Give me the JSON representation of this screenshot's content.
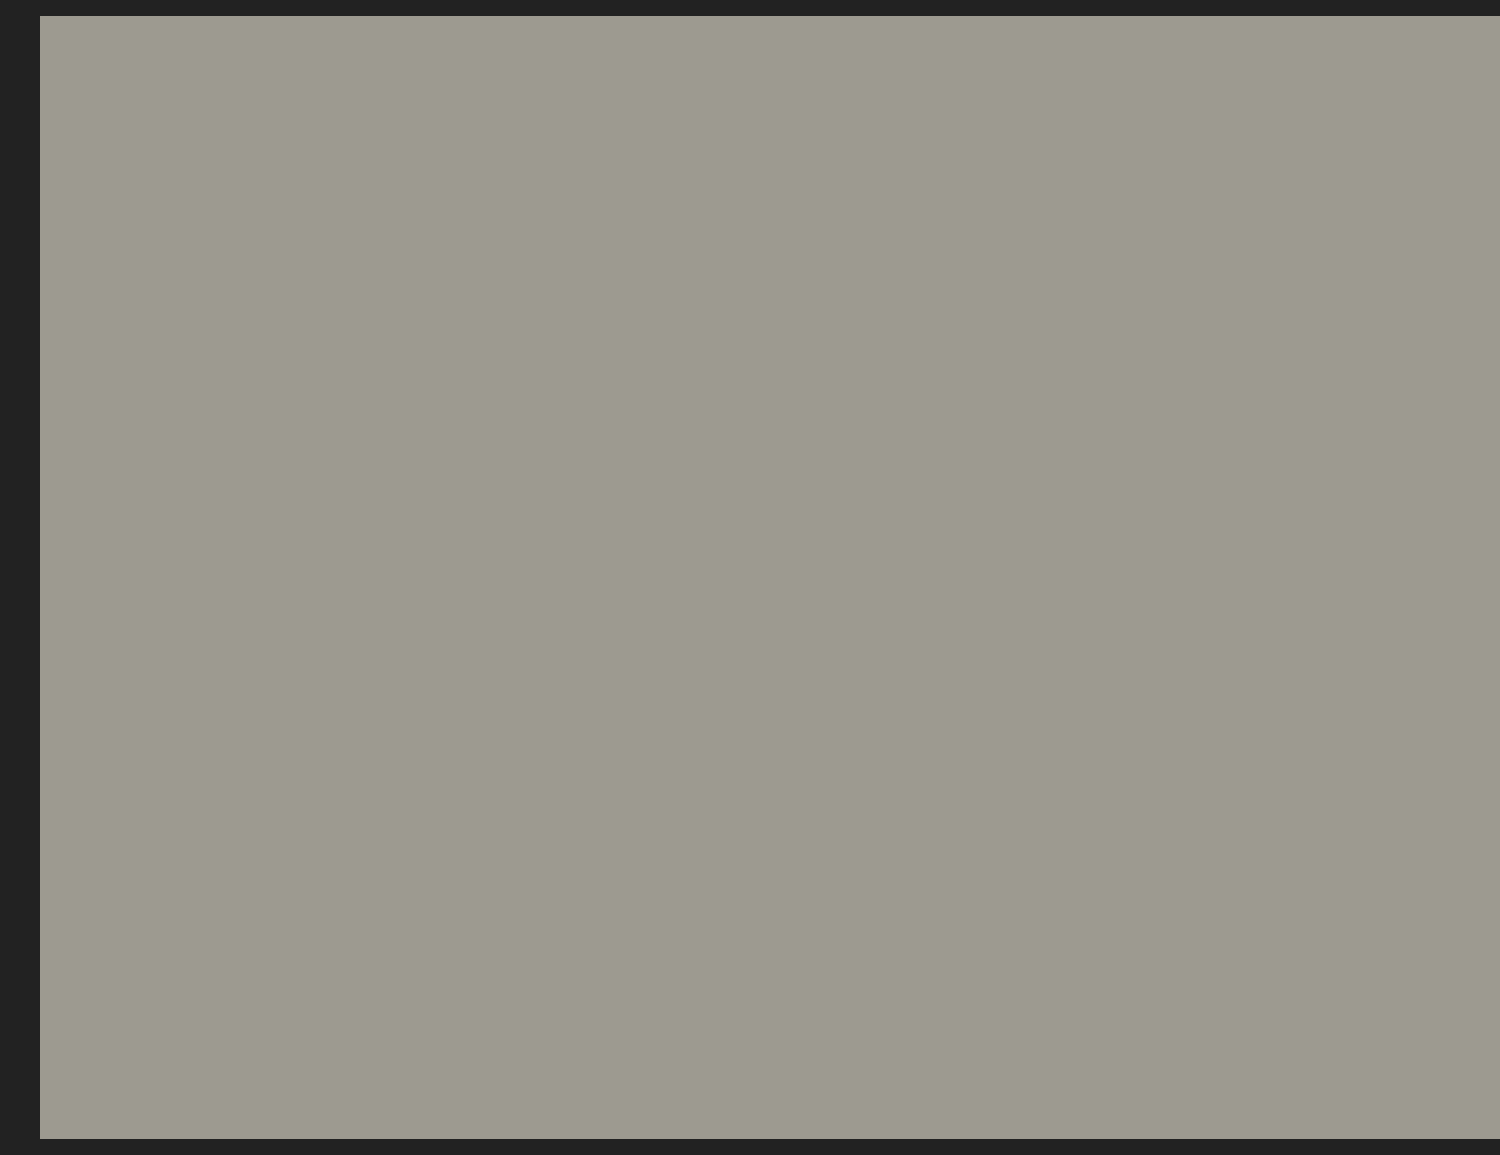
{
  "scene": {
    "alt": "Aerial drone photograph of a suburban subdivision: rows of beige stucco houses with tile roofs along a dark asphalt street, a red map pin marking the tile-roofed house at center, bare orchard rows and a rural highway intersection beyond, autumn trees, backyard swimming pools, solar roofs and a putting green.",
    "marker": {
      "icon": "map-pin-icon",
      "color": "#ee1b17",
      "ring_color": "#171010"
    },
    "landmarks": [
      "orchard rows",
      "rural highway intersection",
      "autumn street trees",
      "two rows of tile-roof houses",
      "neighborhood street",
      "cul-de-sac",
      "backyard pools",
      "putting green",
      "solar panel roofs",
      "parked cars",
      "red map pin"
    ]
  },
  "palette": {
    "haze": "#b6bba9",
    "farGreen": "#9dab8c",
    "farTree": "#6a7a5f",
    "farBuilding": "#dedfd6",
    "plowed": "#52473e",
    "plowedLine": "#463d35",
    "pasture": "#7e9a62",
    "dirt": "#c0a67e",
    "dirtLine": "#a98e66",
    "tarp": "#e2e5e3",
    "orchardFar": "#77736d",
    "orchardMid": "#8b877e",
    "orchardNear": "#a5a295",
    "orchardRow": "#7f7b72",
    "shed": "#e0e0d8",
    "roadGray": "#8f9290",
    "laneWhite": "#e9eae4",
    "shoulder": "#cfd2ca",
    "euc1": "#3f5138",
    "euc2": "#47583d",
    "euc3": "#526249",
    "rust1": "#7a4a33",
    "rust2": "#9a5d3b",
    "aOrange": "#c06a33",
    "aRed": "#a8402c",
    "aRust": "#b65a2f",
    "aYellow": "#d0a03f",
    "aGreen": "#5d7046",
    "dGreen": "#3c4c34",
    "plum": "#6e3c49",
    "olive": "#7a7f5a",
    "lawn": "#7b9450",
    "lawnDark": "#5f7a3e",
    "lawnBright": "#79a054",
    "turf": "#4f7c36",
    "putt": "#69a53f",
    "puttLight": "#8fc45c",
    "upRoof": "#c7a08f",
    "upRoofDark": "#b78c7c",
    "midRoof": "#c9a08d",
    "ridge": "#e9ddd0",
    "wallCream": "#ece5d2",
    "wallTan": "#dfcfae",
    "wallWhite": "#f0ece0",
    "garWhite": "#e9e5da",
    "garBrown": "#5c4434",
    "grayRoof": "#b1a496",
    "grayRoofDark": "#a3968a",
    "frontGable": "#a99b8d",
    "solar": "#22304f",
    "solarLine": "#46598f",
    "asphalt": "#46494c",
    "asphaltLight": "#575b5e",
    "curb": "#ecede7",
    "walk": "#d6d7d0",
    "drive": "#d2d3cb",
    "concrete": "#cbcac1",
    "fence": "#4a3628",
    "fenceRed": "#5a3f2b",
    "gravel": "#cfcec6",
    "mulch": "#6b5a43",
    "poolBlue": "#a2d4de",
    "poolBluePale": "#c6e5e9",
    "poolTeal": "#7ec8c0",
    "poolSmall": "#7cc4cf",
    "pond": "#8fbfa4",
    "pondDark": "#6fa18a",
    "canopy": "#eceeee",
    "pergola": "#eef0ee",
    "carSilver": "#c9cbcb",
    "carDark": "#33363a",
    "carBlack": "#1d1f22",
    "carWhite": "#e8e8e4",
    "carRed": "#b03026",
    "binBlue": "#2f63a8",
    "binGray": "#7a7d80",
    "lamp": "#2a2a28",
    "lampGlow": "#f2f2ea",
    "soil": "#2e2a24",
    "rock": "#938f86",
    "statue": "#e8e6dc",
    "yellowBush": "#b7c04a",
    "stone": "#c3b29b",
    "pinRed": "#ee1b17",
    "pinDark": "#171010"
  }
}
